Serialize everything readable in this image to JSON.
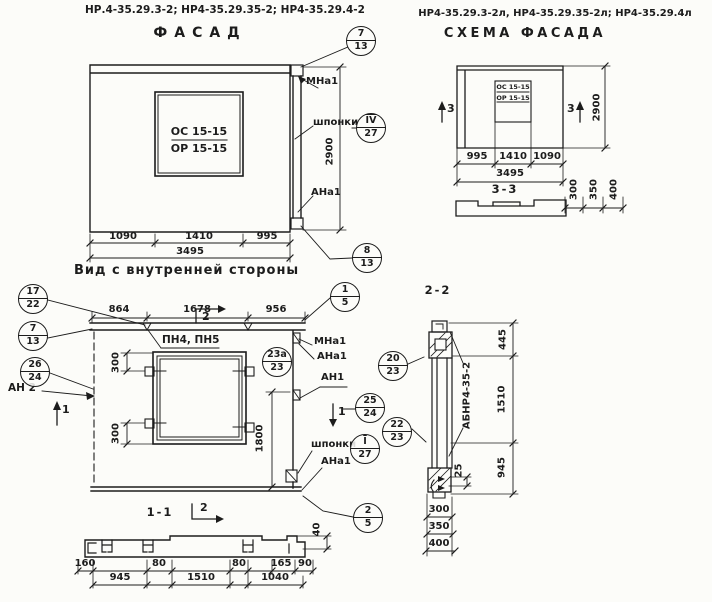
{
  "palette": {
    "ink": "#1c1c1c",
    "paper": "#fcfcf9"
  },
  "header_left": {
    "codes": "НР.4-35.29.3-2; НР4-35.29.35-2; НР4-35.29.4-2",
    "title": "ФАСАД"
  },
  "header_right": {
    "codes": "НР4-35.29.3-2л, НР4-35.29.35-2л; НР4-35.29.4л",
    "title": "СХЕМА ФАСАДА"
  },
  "facade": {
    "window_mark_top": "ОС 15-15",
    "window_mark_bottom": "ОР 15-15",
    "dim_left": "1090",
    "dim_mid": "1410",
    "dim_right": "995",
    "dim_total": "3495",
    "dim_height": "2900",
    "label_mna1": "МНа1",
    "label_shponki": "шпонки",
    "label_ana1": "АНа1"
  },
  "scheme": {
    "window_mark_top": "ОС 15-15",
    "window_mark_bottom": "ОР 15-15",
    "dim_left": "995",
    "dim_mid": "1410",
    "dim_right": "1090",
    "dim_total": "3495",
    "dim_height": "2900",
    "mark_left": "3",
    "mark_right": "3"
  },
  "section33": {
    "title": "3-3",
    "thickness_dims": [
      "300",
      "350",
      "400"
    ]
  },
  "inner_view": {
    "title": "Вид с внутренней стороны",
    "top_dims": [
      "864",
      "1678",
      "956"
    ],
    "label_pn": "ПН4, ПН5",
    "label_an2": "АН 2",
    "label_mna1": "МНа1",
    "label_ana1_top": "АНа1",
    "label_an1": "АН1",
    "label_shponki": "шпонки",
    "label_ana1_bottom": "АНа1",
    "dim_300_top": "300",
    "dim_300_bottom": "300",
    "dim_1800": "1800",
    "mark_1_left": "1",
    "mark_1_right": "1",
    "mark_2": "2"
  },
  "section11": {
    "title": "1-1",
    "mark_2": "2",
    "row1_dims": [
      "160",
      "80",
      "80",
      "165",
      "90"
    ],
    "row2_dims": [
      "945",
      "1510",
      "1040"
    ],
    "dim_40": "40"
  },
  "section22": {
    "title": "2-2",
    "panel_mark": "АБНР4-35-2",
    "side_dims": [
      "445",
      "1510",
      "945"
    ],
    "dim_25": "25",
    "thickness_dims": [
      "300",
      "350",
      "400"
    ]
  },
  "callouts": [
    {
      "top": "7",
      "bottom": "13"
    },
    {
      "top": "IV",
      "bottom": "27"
    },
    {
      "top": "8",
      "bottom": "13"
    },
    {
      "top": "17",
      "bottom": "22"
    },
    {
      "top": "7",
      "bottom": "13"
    },
    {
      "top": "26",
      "bottom": "24"
    },
    {
      "top": "23а",
      "bottom": "23"
    },
    {
      "top": "1",
      "bottom": "5"
    },
    {
      "top": "25",
      "bottom": "24"
    },
    {
      "top": "I",
      "bottom": "27"
    },
    {
      "top": "2",
      "bottom": "5"
    },
    {
      "top": "20",
      "bottom": "23"
    },
    {
      "top": "22",
      "bottom": "23"
    }
  ]
}
